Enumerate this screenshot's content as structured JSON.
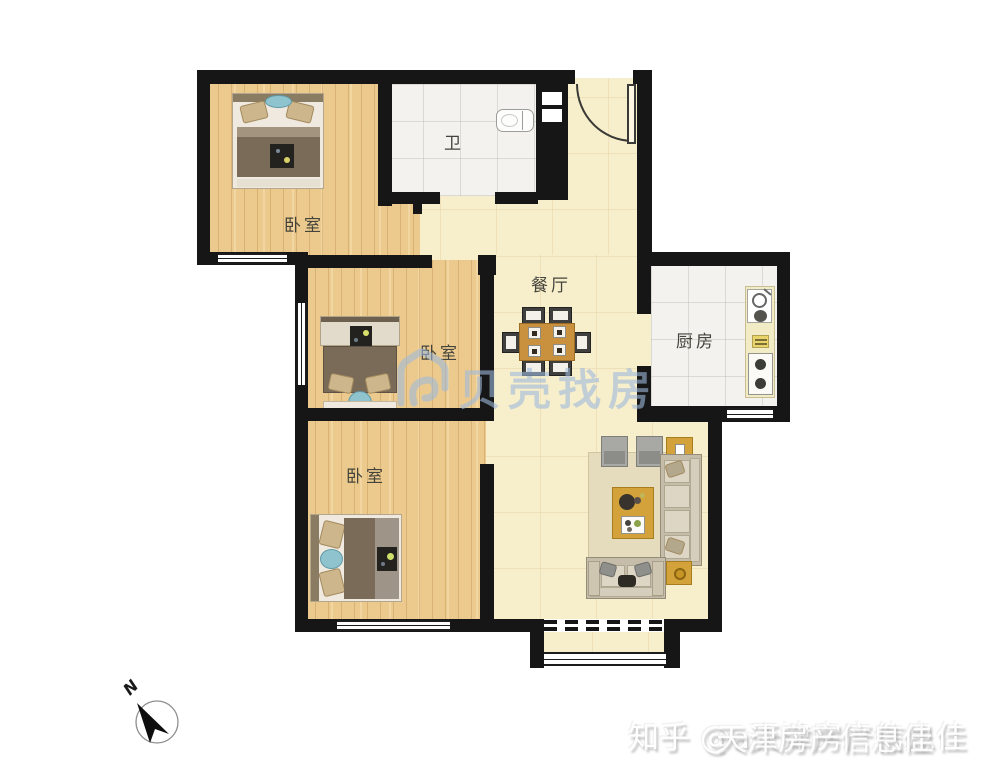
{
  "rooms": {
    "bedroom_top": {
      "label": "卧室"
    },
    "bedroom_middle": {
      "label": "卧室"
    },
    "bedroom_bottom": {
      "label": "卧室"
    },
    "bathroom": {
      "label": "卫"
    },
    "dining": {
      "label": "餐厅"
    },
    "kitchen": {
      "label": "厨房"
    }
  },
  "compass": {
    "label": "N"
  },
  "watermarks": {
    "center_text": "贝壳找房",
    "bottom_text": "知乎 @a天津房产信息佳",
    "bottom_overlay_text": "天津房产信息佳"
  },
  "colors": {
    "wall": "#161616",
    "wood_floor": "#ecca8e",
    "hall_floor": "#f7eecb",
    "tile_floor": "#f3f2ee",
    "watermark_blue": "#9eb9dc",
    "table_wood": "#c9913e",
    "teal_accent": "#8fc3cd"
  }
}
